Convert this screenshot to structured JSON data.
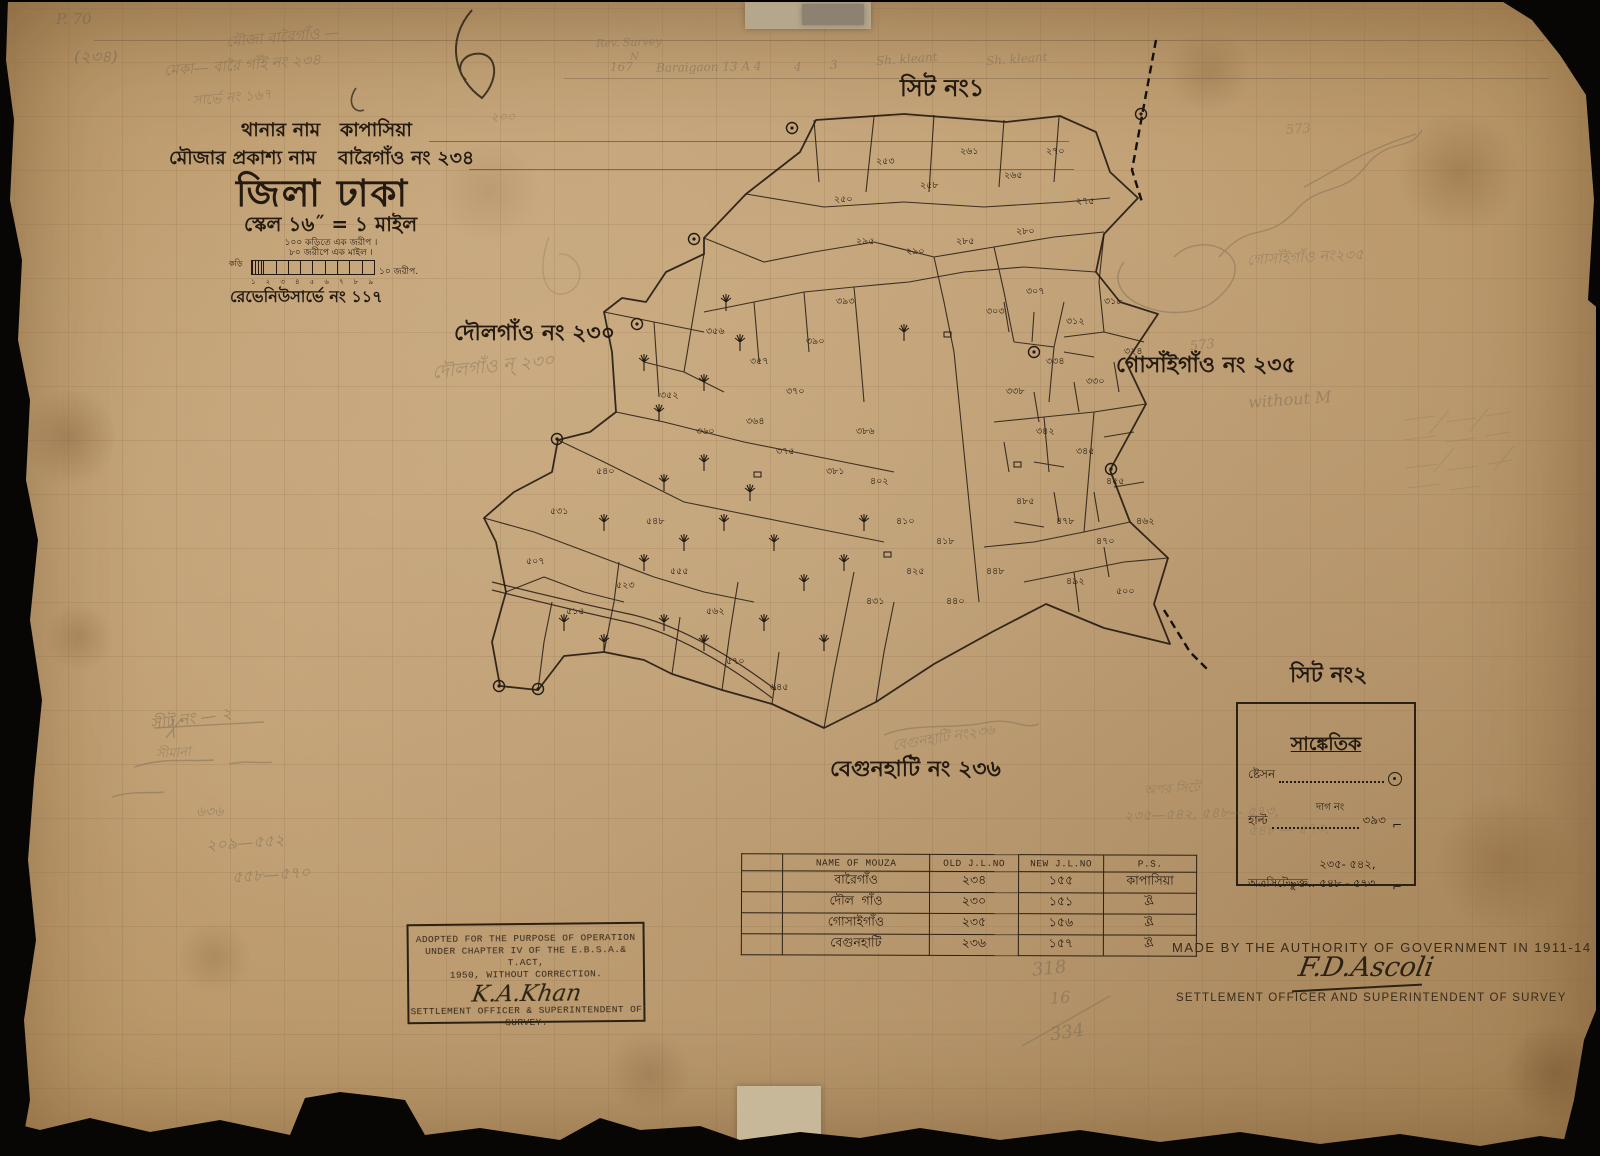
{
  "page_mark": "P. 70",
  "header": {
    "thana_label": "থানার নাম",
    "thana_value": "কাপাসিয়া",
    "mouza_label": "মৌজার প্রকাশ্য নাম",
    "mouza_value": "বারৈগাঁও নং ২৩৪",
    "district": "জিলা ঢাকা",
    "scale": "স্কেল ১৬˝ = ১ মাইল",
    "scale_note_1": "১০০ কড়িতে এক জরীপ  ।",
    "scale_note_2": "৮০ জরীপে এক মাইল  ।",
    "scale_unit_left": "কড়ি",
    "scale_unit_right": "১০  জরীপ.",
    "scale_ticks": [
      "১",
      "২",
      "৩",
      "৪",
      "৫",
      "৬",
      "৭",
      "৮",
      "৯"
    ],
    "revenue_survey": "রেভেনিউসার্ভে নং ১১৭"
  },
  "sheet_labels": {
    "sheet1": "সিট নং১",
    "sheet2": "সিট নং২"
  },
  "map": {
    "village_labels": {
      "doulgaon": "দৌলগাঁও নং ২৩০",
      "gosaigaon": "গোসাঁইগাঁও নং ২৩৫",
      "begunhati": "বেগুনহাটি নং ২৩৬"
    },
    "plot_numbers": [
      {
        "t": "২৫০",
        "x": 830,
        "y": 200
      },
      {
        "t": "২৫৩",
        "x": 872,
        "y": 162
      },
      {
        "t": "২৫৮",
        "x": 916,
        "y": 186
      },
      {
        "t": "২৬১",
        "x": 956,
        "y": 152
      },
      {
        "t": "২৬৫",
        "x": 1000,
        "y": 176
      },
      {
        "t": "২৭০",
        "x": 1042,
        "y": 152
      },
      {
        "t": "২৭৫",
        "x": 1072,
        "y": 202
      },
      {
        "t": "২৮০",
        "x": 1012,
        "y": 232
      },
      {
        "t": "২৮৫",
        "x": 952,
        "y": 242
      },
      {
        "t": "২৯০",
        "x": 902,
        "y": 252
      },
      {
        "t": "২৯৫",
        "x": 852,
        "y": 242
      },
      {
        "t": "৩০৩",
        "x": 982,
        "y": 312
      },
      {
        "t": "৩০৭",
        "x": 1022,
        "y": 292
      },
      {
        "t": "৩১২",
        "x": 1062,
        "y": 322
      },
      {
        "t": "৩১৮",
        "x": 1100,
        "y": 302
      },
      {
        "t": "৩২৪",
        "x": 1120,
        "y": 352
      },
      {
        "t": "৩৩০",
        "x": 1082,
        "y": 382
      },
      {
        "t": "৩৩৪",
        "x": 1042,
        "y": 362
      },
      {
        "t": "৩৩৮",
        "x": 1002,
        "y": 392
      },
      {
        "t": "৩৪২",
        "x": 1032,
        "y": 432
      },
      {
        "t": "৩৪৫",
        "x": 1072,
        "y": 452
      },
      {
        "t": "৩৫২",
        "x": 656,
        "y": 396
      },
      {
        "t": "৩৫৬",
        "x": 702,
        "y": 332
      },
      {
        "t": "৩৫৭",
        "x": 746,
        "y": 362
      },
      {
        "t": "৩৬০",
        "x": 692,
        "y": 432
      },
      {
        "t": "৩৬৪",
        "x": 742,
        "y": 422
      },
      {
        "t": "৩৭০",
        "x": 782,
        "y": 392
      },
      {
        "t": "৩৭৫",
        "x": 772,
        "y": 452
      },
      {
        "t": "৩৮১",
        "x": 822,
        "y": 472
      },
      {
        "t": "৩৮৬",
        "x": 852,
        "y": 432
      },
      {
        "t": "৩৯০",
        "x": 802,
        "y": 342
      },
      {
        "t": "৩৯৩",
        "x": 832,
        "y": 302
      },
      {
        "t": "৪০২",
        "x": 866,
        "y": 482
      },
      {
        "t": "৪১০",
        "x": 892,
        "y": 522
      },
      {
        "t": "৪১৮",
        "x": 932,
        "y": 542
      },
      {
        "t": "৪২৫",
        "x": 902,
        "y": 572
      },
      {
        "t": "৪৩১",
        "x": 862,
        "y": 602
      },
      {
        "t": "৪৪০",
        "x": 942,
        "y": 602
      },
      {
        "t": "৪৪৮",
        "x": 982,
        "y": 572
      },
      {
        "t": "৪৫৫",
        "x": 1102,
        "y": 482
      },
      {
        "t": "৪৬২",
        "x": 1132,
        "y": 522
      },
      {
        "t": "৪৭০",
        "x": 1092,
        "y": 542
      },
      {
        "t": "৪৭৮",
        "x": 1052,
        "y": 522
      },
      {
        "t": "৪৮৫",
        "x": 1012,
        "y": 502
      },
      {
        "t": "৪৯২",
        "x": 1062,
        "y": 582
      },
      {
        "t": "৫০০",
        "x": 1112,
        "y": 592
      },
      {
        "t": "৫০৭",
        "x": 522,
        "y": 562
      },
      {
        "t": "৫১৫",
        "x": 562,
        "y": 612
      },
      {
        "t": "৫২৩",
        "x": 612,
        "y": 586
      },
      {
        "t": "৫৩১",
        "x": 546,
        "y": 512
      },
      {
        "t": "৫৪০",
        "x": 592,
        "y": 472
      },
      {
        "t": "৫৪৮",
        "x": 642,
        "y": 522
      },
      {
        "t": "৫৫৫",
        "x": 666,
        "y": 572
      },
      {
        "t": "৫৬২",
        "x": 702,
        "y": 612
      },
      {
        "t": "৫৭০",
        "x": 722,
        "y": 662
      },
      {
        "t": "৬৪৫",
        "x": 766,
        "y": 688
      }
    ]
  },
  "legend": {
    "title": "সাঙ্কেতিক",
    "station_label": "ষ্টেসন",
    "halt_label": "হাল্ট",
    "dag_label": "দাগ নং",
    "halt_value": "৩৯৩",
    "included_label": "অত্রসিটেভুক্ত..",
    "included_value": "২৩৫- ৫৪২, ৫৪৮ - ৫৭৩"
  },
  "stamp": {
    "line1": "ADOPTED FOR THE PURPOSE OF OPERATION",
    "line2": "UNDER CHAPTER IV OF THE E.B.S.A.& T.ACT,",
    "line3": "1950, WITHOUT CORRECTION.",
    "signature": "K.A.Khan",
    "office1": "SETTLEMENT OFFICER & SUPERINTENDENT OF",
    "office2": "SURVEY."
  },
  "table": {
    "headers": [
      "NAME OF MOUZA",
      "OLD J.L.NO",
      "NEW J.L.NO",
      "P.S."
    ],
    "rows": [
      [
        "বারৈগাঁও",
        "২৩৪",
        "১৫৫",
        "কাপাসিয়া"
      ],
      [
        "দৌল গাঁও",
        "২৩০",
        "১৫১",
        "ঐ"
      ],
      [
        "গোসাইগাঁও",
        "২৩৫",
        "১৫৬",
        "ঐ"
      ],
      [
        "বেগুনহাটি",
        "২৩৬",
        "১৫৭",
        "ঐ"
      ]
    ]
  },
  "footer": {
    "made_by": "MADE BY THE AUTHORITY OF GOVERNMENT IN 1911-14",
    "signature": "F.D.Ascoli",
    "office": "SETTLEMENT OFFICER AND SUPERINTENDENT OF SURVEY"
  },
  "pencil": [
    {
      "t": "P. 70",
      "x": 52,
      "y": 8,
      "s": 15,
      "r": 0,
      "o": 0.75
    },
    {
      "t": "(২৩৪)",
      "x": 70,
      "y": 42,
      "s": 16,
      "r": 0,
      "o": 0.7
    },
    {
      "t": "মৌজা বারৈগাঁও —",
      "x": 222,
      "y": 24,
      "s": 15,
      "r": -5,
      "o": 0.55
    },
    {
      "t": "মেকা— বারৈ গাঁই নং ২৩৪",
      "x": 160,
      "y": 52,
      "s": 15,
      "r": -4,
      "o": 0.55
    },
    {
      "t": "সার্ভে নং ১৬৭",
      "x": 188,
      "y": 84,
      "s": 14,
      "r": -5,
      "o": 0.5
    },
    {
      "t": "Rev. Survey",
      "x": 592,
      "y": 34,
      "s": 11,
      "r": -2,
      "o": 0.5
    },
    {
      "t": "N",
      "x": 626,
      "y": 50,
      "s": 10,
      "r": 0,
      "o": 0.5
    },
    {
      "t": "167",
      "x": 606,
      "y": 58,
      "s": 12,
      "r": 0,
      "o": 0.55
    },
    {
      "t": "Baraigaon 13 A 4",
      "x": 652,
      "y": 58,
      "s": 12,
      "r": -1,
      "o": 0.55
    },
    {
      "t": "4",
      "x": 790,
      "y": 58,
      "s": 12,
      "r": 0,
      "o": 0.5
    },
    {
      "t": "3",
      "x": 826,
      "y": 56,
      "s": 12,
      "r": 0,
      "o": 0.55
    },
    {
      "t": "Sh. kleant",
      "x": 872,
      "y": 50,
      "s": 12,
      "r": -4,
      "o": 0.55
    },
    {
      "t": "Sh. kleant",
      "x": 982,
      "y": 50,
      "s": 12,
      "r": -4,
      "o": 0.5
    },
    {
      "t": "২০০",
      "x": 486,
      "y": 106,
      "s": 13,
      "r": 0,
      "o": 0.45
    },
    {
      "t": "573",
      "x": 1282,
      "y": 120,
      "s": 13,
      "r": -4,
      "o": 0.4
    },
    {
      "t": "573",
      "x": 1186,
      "y": 336,
      "s": 13,
      "r": -6,
      "o": 0.5
    },
    {
      "t": "গোসাঁইগাঁও নং২৩৫",
      "x": 1243,
      "y": 244,
      "s": 15,
      "r": -3,
      "o": 0.45
    },
    {
      "t": "without M",
      "x": 1244,
      "y": 388,
      "s": 16,
      "r": -4,
      "o": 0.5
    },
    {
      "t": "দৌলগাঁও ন্‌ ২৩০",
      "x": 428,
      "y": 350,
      "s": 18,
      "r": -6,
      "o": 0.5
    },
    {
      "t": "বেগুনহাটি নং২৩৬",
      "x": 888,
      "y": 724,
      "s": 14,
      "r": -9,
      "o": 0.45
    },
    {
      "t": "সীট নং — ২",
      "x": 146,
      "y": 704,
      "s": 16,
      "r": -8,
      "o": 0.55
    },
    {
      "t": "সীমানা",
      "x": 152,
      "y": 742,
      "s": 13,
      "r": -4,
      "o": 0.45
    },
    {
      "t": "৬৩৬",
      "x": 192,
      "y": 798,
      "s": 14,
      "r": 0,
      "o": 0.5
    },
    {
      "t": "২০৯—৫৫২",
      "x": 202,
      "y": 828,
      "s": 16,
      "r": -4,
      "o": 0.55
    },
    {
      "t": "৫৫৮—৫৭০",
      "x": 228,
      "y": 860,
      "s": 16,
      "r": -4,
      "o": 0.55
    },
    {
      "t": "অপর সিটে",
      "x": 1140,
      "y": 778,
      "s": 13,
      "r": -3,
      "o": 0.45
    },
    {
      "t": "২৩৫—৫৪২, ৫৪৮— ৫৭৩,",
      "x": 1120,
      "y": 800,
      "s": 14,
      "r": -2,
      "o": 0.5
    },
    {
      "t": "৫৪৮ — ৫৭৩,",
      "x": 1244,
      "y": 816,
      "s": 14,
      "r": -2,
      "o": 0.4
    },
    {
      "t": "318",
      "x": 1028,
      "y": 956,
      "s": 18,
      "r": -6,
      "o": 0.55
    },
    {
      "t": "16",
      "x": 1046,
      "y": 986,
      "s": 16,
      "r": -4,
      "o": 0.55
    },
    {
      "t": "334",
      "x": 1046,
      "y": 1020,
      "s": 18,
      "r": -8,
      "o": 0.55
    }
  ],
  "colors": {
    "paper": "#c2a176",
    "ink": "#241a10",
    "pencil": "#7c6b53"
  }
}
